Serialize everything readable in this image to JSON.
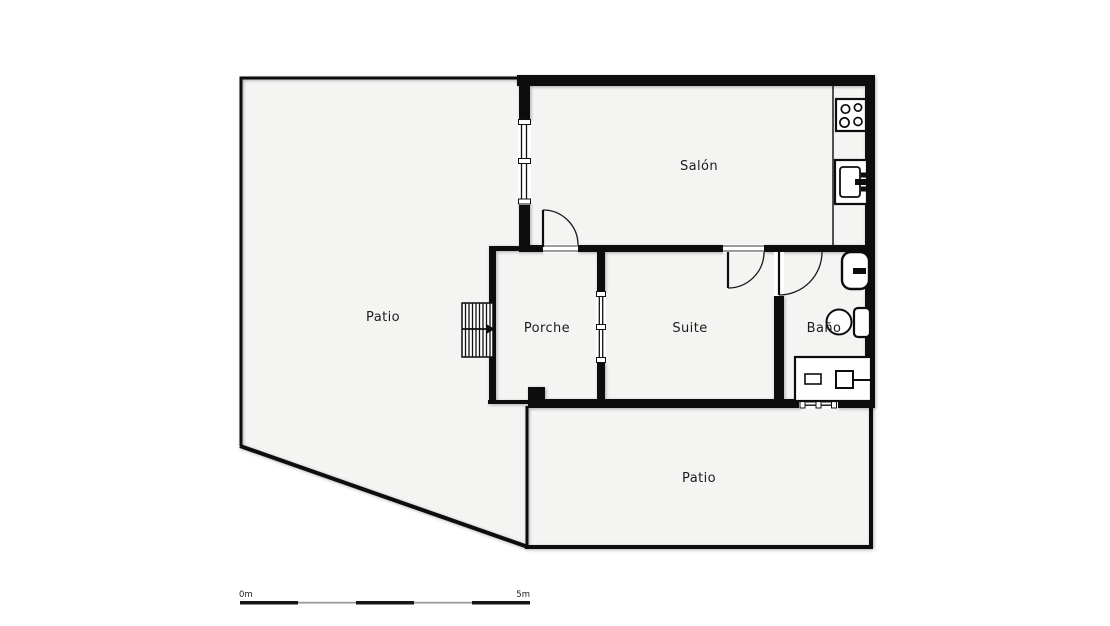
{
  "page": {
    "type_label": "floor-plan"
  },
  "rooms": {
    "salon": {
      "label": "Salón"
    },
    "patio_left": {
      "label": "Patio"
    },
    "porche": {
      "label": "Porche"
    },
    "suite": {
      "label": "Suite"
    },
    "bano": {
      "label": "Baño"
    },
    "patio_bottom": {
      "label": "Patio"
    }
  },
  "scale_bar": {
    "start_label": "0m",
    "end_label": "5m"
  },
  "icons": {
    "stove": "stove-burners-icon",
    "kitchen_sink": "kitchen-sink-icon",
    "washbasin": "washbasin-icon",
    "toilet": "toilet-icon",
    "vanity": "vanity-counter-icon",
    "stairs": "stairs-icon",
    "door": "door-swing-icon",
    "window": "window-icon"
  },
  "colors": {
    "wall": "#0d0d0d",
    "room_fill": "#f4f4f3",
    "background": "#ffffff",
    "text": "#1c1c1c",
    "scale_muted": "#9b9b9b",
    "thin_line": "#111111"
  }
}
